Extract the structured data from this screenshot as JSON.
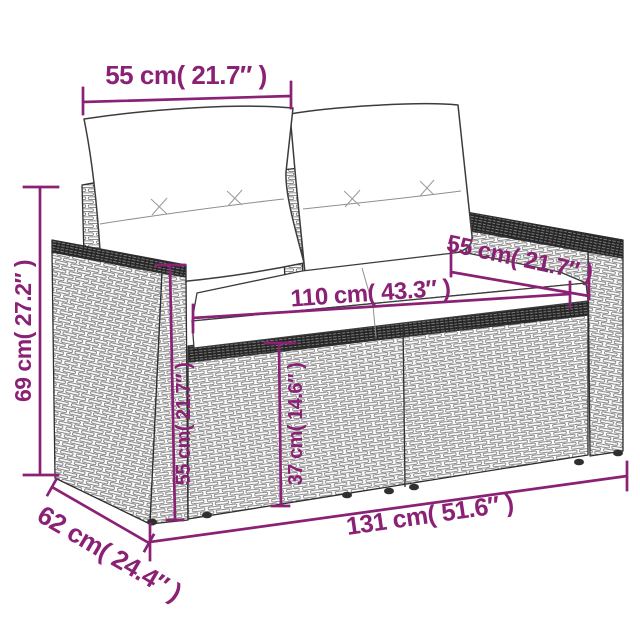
{
  "diagram": {
    "type": "product-dimension-diagram",
    "subject": "two-seater poly rattan garden sofa with back and seat cushions",
    "dimension_color": "#8A2175",
    "line_art_color": "#2e2e2e",
    "dimensions": {
      "back_width": {
        "cm": 55,
        "inches": 21.7,
        "label": "55 cm( 21.7″ )"
      },
      "height": {
        "cm": 69,
        "inches": 27.2,
        "label": "69 cm( 27.2″ )"
      },
      "arm_depth": {
        "cm": 55,
        "inches": 21.7,
        "label": "55 cm( 21.7″ )"
      },
      "seat_width": {
        "cm": 110,
        "inches": 43.3,
        "label": "110 cm( 43.3″ )"
      },
      "arm_height": {
        "cm": 55,
        "inches": 21.7,
        "label": "55 cm( 21.7″ )"
      },
      "seat_height": {
        "cm": 37,
        "inches": 14.6,
        "label": "37 cm( 14.6″ )"
      },
      "total_width": {
        "cm": 131,
        "inches": 51.6,
        "label": "131 cm( 51.6″ )"
      },
      "total_depth": {
        "cm": 62,
        "inches": 24.4,
        "label": "62 cm( 24.4″ )"
      }
    }
  }
}
